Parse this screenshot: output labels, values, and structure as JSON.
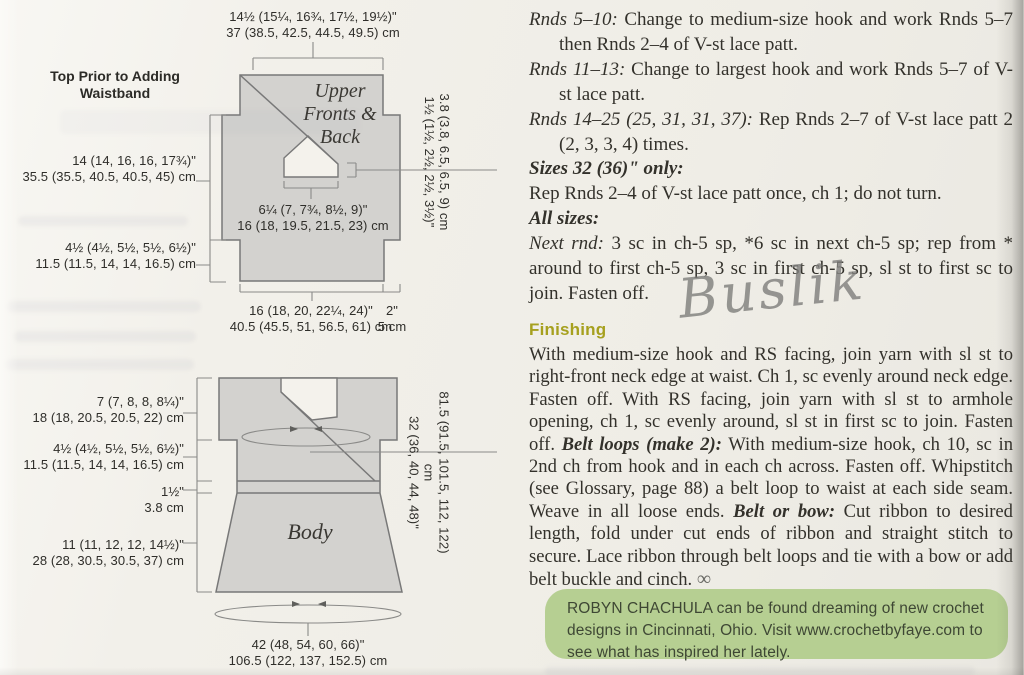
{
  "colors": {
    "page_bg": "#f0eee8",
    "diagram_fill": "#d3d2cf",
    "diagram_stroke": "#787878",
    "finishing_heading": "#a6a01e",
    "bio_bg": "#b6cf92",
    "bio_text": "#3e4734",
    "watermark_gray": "#9a9a97"
  },
  "diagram_title": "Top Prior to Adding Waistband",
  "upper": {
    "label_lines": [
      "Upper",
      "Fronts &",
      "Back"
    ],
    "top_in": "14½ (15¼, 16¾, 17½, 19½)\"",
    "top_cm": "37 (38.5, 42.5, 44.5, 49.5) cm",
    "side_in": "14 (14, 16, 16, 17¾)\"",
    "side_cm": "35.5 (35.5, 40.5, 40.5, 45) cm",
    "lower_side_in": "4½ (4½, 5½, 5½, 6½)\"",
    "lower_side_cm": "11.5 (11.5, 14, 14, 16.5) cm",
    "neck_in": "6¼ (7, 7¾, 8½, 9)\"",
    "neck_cm": "16 (18, 19.5, 21.5, 23) cm",
    "neck_depth_in": "1½ (1½, 2½, 2½, 3½)\"",
    "neck_depth_cm": "3.8 (3.8, 6.5, 6.5, 9) cm",
    "bottom_in": "16 (18, 20, 22¼, 24)\"",
    "bottom_cm": "40.5 (45.5, 51, 56.5, 61) cm",
    "step_in": "2\"",
    "step_cm": "5 cm"
  },
  "body": {
    "label": "Body",
    "yoke_in": "7 (7, 8, 8, 8¼)\"",
    "yoke_cm": "18 (18, 20.5, 20.5, 22) cm",
    "underarm_in": "4½ (4½, 5½, 5½, 6½)\"",
    "underarm_cm": "11.5 (11.5, 14, 14, 16.5) cm",
    "waistband_in": "1½\"",
    "waistband_cm": "3.8 cm",
    "skirt_in": "11 (11, 12, 12, 14½)\"",
    "skirt_cm": "28 (28, 30.5, 30.5, 37) cm",
    "bust_in": "32 (36, 40, 44, 48)\"",
    "bust_cm": "81.5 (91.5, 101.5, 112, 122) cm",
    "hem_in": "42 (48, 54, 60, 66)\"",
    "hem_cm": "106.5 (122, 137, 152.5) cm"
  },
  "instructions": {
    "paragraphs": [
      {
        "lead": "Rnds 5–10:",
        "text": " Change to medium-size hook and work Rnds 5–7 then Rnds 2–4 of V-st lace patt."
      },
      {
        "lead": "Rnds 11–13:",
        "text": " Change to largest hook and work Rnds 5–7 of V-st lace patt."
      },
      {
        "lead": "Rnds 14–25 (25, 31, 31, 37):",
        "text": " Rep Rnds 2–7 of V-st lace patt 2 (2, 3, 3, 4) times."
      }
    ],
    "sizes_heading": "Sizes 32 (36)\" only:",
    "sizes_text": "Rep Rnds 2–4 of V-st lace patt once, ch 1; do not turn.",
    "all_sizes_heading": "All sizes:",
    "next_rnd_lead": "Next rnd:",
    "next_rnd_text": " 3 sc in ch-5 sp, *6 sc in next ch-5 sp; rep from * around to first ch-5 sp, 3 sc in first ch-5 sp, sl st to first sc to join. Fasten off."
  },
  "finishing": {
    "heading": "Finishing",
    "seg1": "With medium-size hook and RS facing, join yarn with sl st to right-front neck edge at waist. Ch 1, sc evenly around neck edge. Fasten off. With RS facing, join yarn with sl st to armhole opening, ch 1, sc evenly around, sl st in first sc to join. Fasten off. ",
    "belt_loops_lead": "Belt loops (make 2):",
    "seg2": " With medium-size hook, ch 10, sc in 2nd ch from hook and in each ch across. Fasten off. Whipstitch (see Glossary, page 88) a belt loop to waist at each side seam. Weave in all loose ends. ",
    "belt_bow_lead": "Belt or bow:",
    "seg3": " Cut ribbon to desired length, fold under cut ends of ribbon and straight stitch to secure. Lace ribbon through belt loops and tie with a bow or add belt buckle and cinch. ",
    "end_mark": "∞"
  },
  "bio": {
    "name": "ROBYN CHACHULA",
    "text": " can be found dreaming of new crochet designs in Cincinnati, Ohio. Visit www.crochetbyfaye.com to see what has inspired her lately."
  },
  "watermark": "Buslik"
}
